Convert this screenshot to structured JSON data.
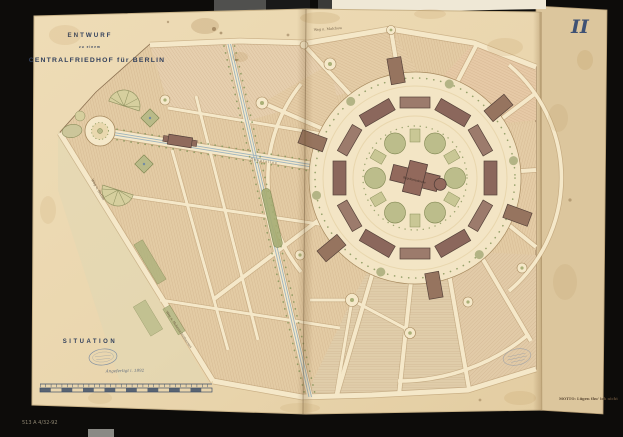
{
  "scene": {
    "description": "Archival photograph of a 19th-century competition plan, unfolded double plate on a black mount",
    "plate_number": "II"
  },
  "title_block": {
    "line1": "ENTWURF",
    "line2": "zu einem",
    "line3": "CENTRALFRIEDHOF für BERLIN"
  },
  "annotations": {
    "situation": "SITUATION",
    "date_note": "Angefertigt i. 1892",
    "motto": "MOTTO: Lügen thu' ich nicht",
    "catalog_mark": "513 A 4/32-92"
  },
  "map_labels": {
    "road_top": "Weg n. Malchow",
    "road_left": "Weg v. Berlin",
    "road_bottom": "Weg n. Hohenschönhausen",
    "central_building": "Begräbnisskirche",
    "main_avenue": "Hauptallee"
  },
  "colors": {
    "mount_background": "#0d0c0a",
    "paper": "#ebd8b1",
    "paper_underlay": "#dcc69d",
    "burial_field": "#e3cba4",
    "road": "#f5e8c9",
    "building": "#9a7a6b",
    "garden_green": "#b9ba88",
    "railway_blue": "#9db3bd",
    "ink_navy": "#32405c",
    "stamp_blue": "#7487a0"
  }
}
